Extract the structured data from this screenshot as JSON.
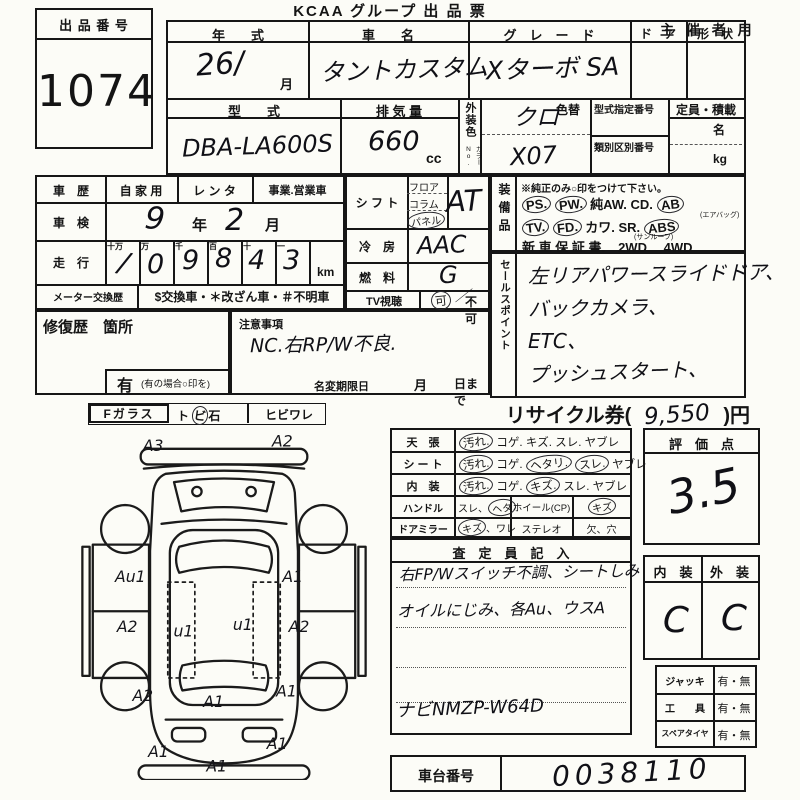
{
  "header": {
    "title": "KCAA グループ 出 品 票",
    "audience": "主 催 者 用",
    "lot_label": "出 品 番 号",
    "lot_number": "1074"
  },
  "vehicle": {
    "year_label": "年　　式",
    "year_value": "26/",
    "month_suffix": "月",
    "name_label": "車　　名",
    "name_value": "タントカスタム",
    "grade_label": "グ　レ　ー　ド",
    "grade_value": "Xターボ SA",
    "door_label": "ド　ア",
    "shape_label": "形　状",
    "model_label": "型　　式",
    "model_value": "DBA-LA600S",
    "displacement_label": "排 気 量",
    "displacement_value": "660",
    "cc": "cc",
    "ext_color_label": "外装色",
    "color_no_label": "カラーNo.",
    "color_change_label": "色替",
    "color_value": "クロ",
    "color_no_value": "X07",
    "type_cert_label": "型式指定番号",
    "class_label": "類別区別番号",
    "capacity_label": "定員・積載",
    "persons_suffix": "名",
    "kg_suffix": "kg"
  },
  "history": {
    "use_label": "車　歴",
    "use_options": [
      "自 家 用",
      "レ ン タ",
      "事業.営業車"
    ],
    "inspection_label": "車　検",
    "inspection_year": "9",
    "year_unit": "年",
    "inspection_month": "2",
    "month_unit": "月",
    "odometer_label": "走　行",
    "digit_units": [
      "十万",
      "万",
      "千",
      "百",
      "十",
      "一"
    ],
    "digits": [
      "/",
      "0",
      "9",
      "8",
      "4",
      "3"
    ],
    "km_unit": "km",
    "meter_label": "メーター交換歴",
    "meter_codes": "$交換車・＊改ざん車・＃不明車"
  },
  "repair": {
    "label": "修復歴　箇所",
    "has_label": "有",
    "has_note": "(有の場合○印を)",
    "caution_label": "注意事項",
    "caution_value": "NC.右RP/W不良.",
    "name_change_label": "名変期限日",
    "month_unit": "月",
    "day_suffix": "日まで"
  },
  "controls": {
    "shift_label": "シ フ ト",
    "shift_options": [
      "フロア",
      "コラム",
      "パネル"
    ],
    "shift_value": "AT",
    "ac_label": "冷　房",
    "ac_value": "AAC",
    "fuel_label": "燃　料",
    "fuel_value": "G",
    "tv_label": "TV視聴",
    "tv_ok": "可",
    "tv_ng": "不可"
  },
  "equipment": {
    "label": "装備品",
    "note": "※純正のみ○印をつけて下さい。",
    "row1": [
      "PS.",
      "PW.",
      "純AW.",
      "CD.",
      "AB"
    ],
    "airbag_note": "(エアバッグ)",
    "row2": [
      "TV.",
      "FD.",
      "カワ.",
      "SR.",
      "ABS"
    ],
    "sunroof_note": "(サンルーフ)",
    "row3": [
      "新 車 保 証 書.",
      "2WD.",
      "4WD"
    ]
  },
  "sales_points": {
    "label": "セールスポイント",
    "lines": [
      "左リアパワースライドドア、",
      "バックカメラ、",
      "ETC、",
      "プッシュスタート、"
    ]
  },
  "recycle": {
    "prefix": "リサイクル券(",
    "amount": "9,550",
    "suffix": ")円"
  },
  "condition": {
    "rows": [
      {
        "label": "天　張",
        "items": [
          "汚れ.",
          "コゲ.",
          "キズ.",
          "スレ.",
          "ヤブレ"
        ]
      },
      {
        "label": "シ ー ト",
        "items": [
          "汚れ.",
          "コゲ.",
          "ヘタリ.",
          "スレ.",
          "ヤブレ"
        ]
      },
      {
        "label": "内　装",
        "items": [
          "汚れ.",
          "コゲ.",
          "キズ.",
          "スレ.",
          "ヤブレ"
        ]
      }
    ],
    "handle": {
      "label": "ハンドル",
      "i1": "スレ、",
      "i2": "ヘタ",
      "wheel_label": "ホイール(CP)",
      "wheel_item": "キズ"
    },
    "mirror": {
      "label": "ドアミラー",
      "i1": "キズ",
      "i2": "、ワレ",
      "stereo_label": "ステレオ",
      "stereo_item": "欠、穴"
    }
  },
  "assessor": {
    "header": "査　定　員　記　入",
    "line1": "右FP/Wスイッチ不調、シートしみ",
    "line2": "オイルにじみ、各Au、ウスA",
    "note": "ナビNMZP-W64D"
  },
  "score": {
    "label": "評　価　点",
    "value": "3.5"
  },
  "grades": {
    "interior_label": "内　装",
    "exterior_label": "外　装",
    "interior": "C",
    "exterior": "C"
  },
  "accessories": {
    "rows": [
      {
        "label": "ジャッキ",
        "value": "有・無"
      },
      {
        "label": "工　　具",
        "value": "有・無"
      },
      {
        "label": "スペアタイヤ",
        "value": "有・無"
      }
    ]
  },
  "chassis": {
    "label": "車台番号",
    "value": "0038110"
  },
  "glass": {
    "f_label": "Fガラス",
    "stone_parts": [
      "ト",
      "ビ",
      "石"
    ],
    "crack_label": "ヒビワレ"
  },
  "diagram": {
    "codes": [
      "A3",
      "A2",
      "Au1",
      "A1",
      "A2",
      "A2",
      "u1",
      "u1",
      "A2",
      "A1",
      "A1",
      "A1",
      "A1",
      "A1"
    ]
  },
  "marks": {
    "circled": [
      "シフト:パネル",
      "TV視聴:可",
      "PS",
      "PW",
      "AB",
      "TV",
      "FD",
      "ABS",
      "天張:汚れ",
      "シート:汚れ",
      "シート:ヘタリ",
      "シート:スレ",
      "内装:汚れ",
      "内装:キズ",
      "ハンドル:ヘタ",
      "ホイール:キズ",
      "ドアミラー:キズ",
      "トビ石:ビ"
    ]
  }
}
